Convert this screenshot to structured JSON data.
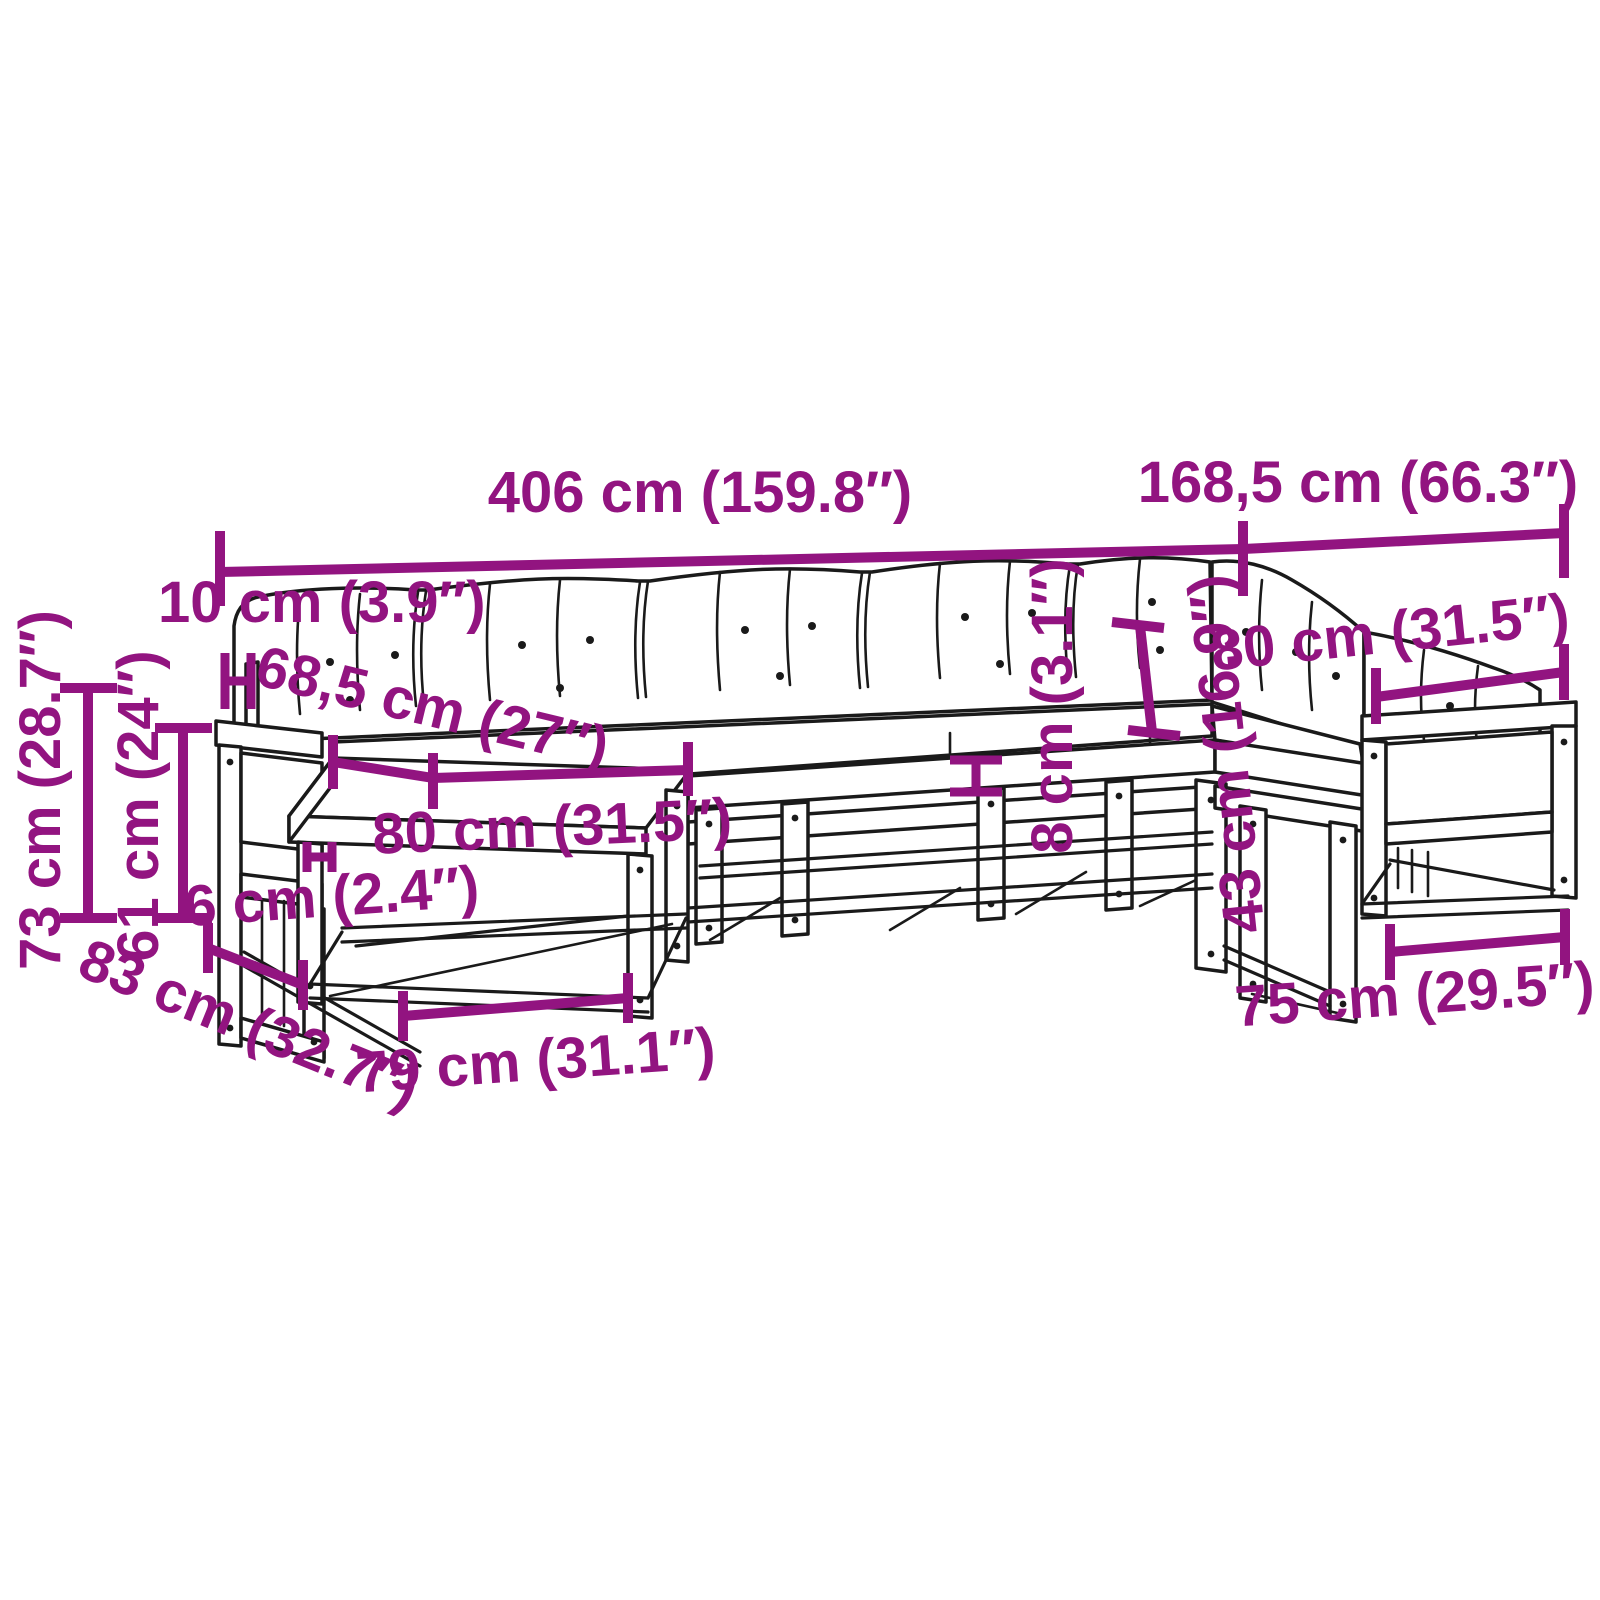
{
  "title": "Garden sofa set dimension diagram",
  "colors": {
    "accent": "#921480",
    "ink": "#1a1a1a",
    "background": "#ffffff"
  },
  "labels": {
    "total_width": "406 cm (159.8″)",
    "right_section_width": "168,5 cm (66.3″)",
    "armrest_top_depth": "10 cm (3.9″)",
    "seat_depth": "68,5 cm (27″)",
    "total_height": "73 cm (28.7″)",
    "armrest_height": "61 cm (24″)",
    "module_width": "80 cm (31.5″)",
    "seat_gap": "6 cm (2.4″)",
    "module_depth": "83 cm (32.7″)",
    "footstool_width": "79 cm (31.1″)",
    "seat_board_thickness": "8 cm (3.1″)",
    "backrest_height": "43 cm (16.9″)",
    "right_module_width": "80 cm (31.5″)",
    "right_module_inner_width": "75 cm (29.5″)"
  }
}
